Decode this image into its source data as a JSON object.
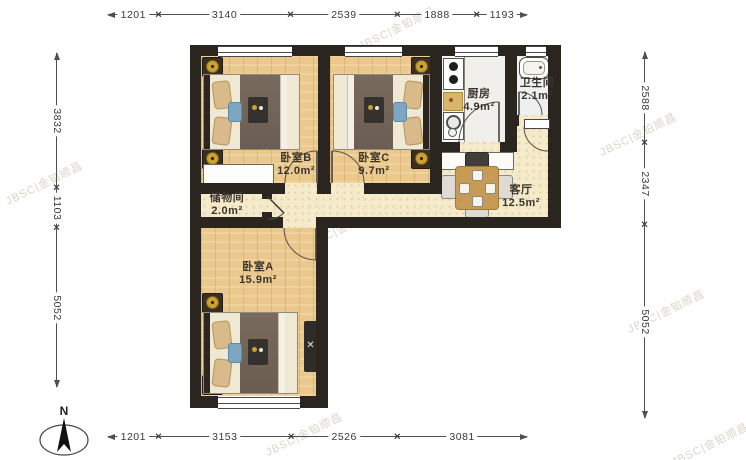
{
  "compass": {
    "label": "N"
  },
  "dimensions": {
    "top": [
      "1201",
      "3140",
      "2539",
      "1888",
      "1193"
    ],
    "bottom": [
      "1201",
      "3153",
      "2526",
      "3081"
    ],
    "left": [
      "3832",
      "1103",
      "5052"
    ],
    "right": [
      "2588",
      "2347",
      "5052"
    ]
  },
  "rooms": [
    {
      "name": "卧室B",
      "area": "12.0m²"
    },
    {
      "name": "卧室C",
      "area": "9.7m²"
    },
    {
      "name": "厨房",
      "area": "4.9m²"
    },
    {
      "name": "卫生间",
      "area": "2.1m²"
    },
    {
      "name": "客厅",
      "area": "12.5m²"
    },
    {
      "name": "储物间",
      "area": "2.0m²"
    },
    {
      "name": "卧室A",
      "area": "15.9m²"
    }
  ],
  "watermark": "JBSC|金铂顺昌",
  "colors": {
    "wall": "#2a261f",
    "wood_floor": "#ebc88e",
    "hall_floor": "#f5ebcb",
    "kitchen_floor": "#f0efeb",
    "bath_floor": "#eef0f0",
    "lamp_gold": "#c9a22f",
    "pillow_blue": "#7ca6c2",
    "table_wood": "#c79a55"
  }
}
